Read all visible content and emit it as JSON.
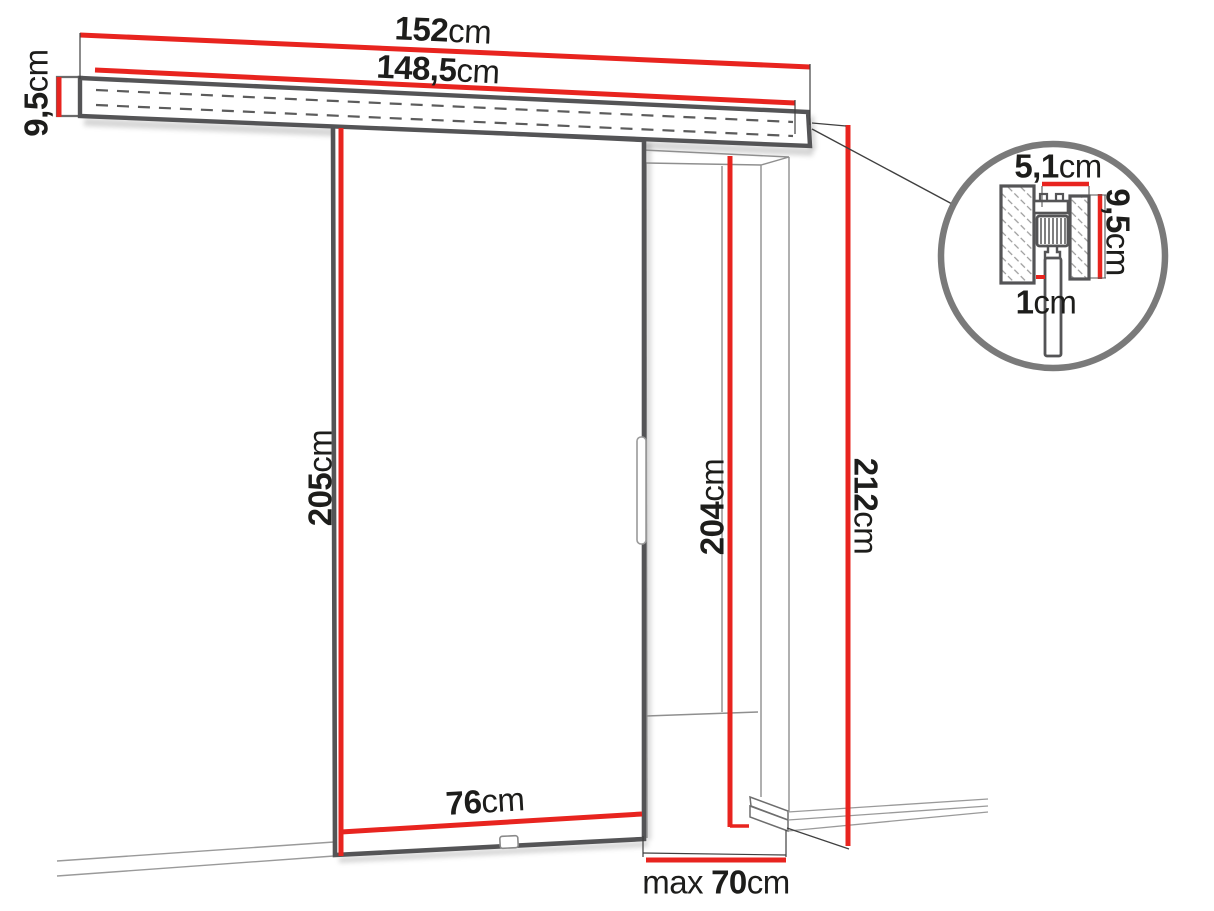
{
  "colors": {
    "dimension_red": "#e8241f",
    "structure_dark": "#545456",
    "line_light": "#8f8f8f",
    "text": "#1d1d1b"
  },
  "labels": {
    "rail_outer_width": {
      "value": "152",
      "unit": "cm"
    },
    "rail_inner_width": {
      "value": "148,5",
      "unit": "cm"
    },
    "rail_profile_height": {
      "value": "9,5",
      "unit": "cm"
    },
    "door_height": {
      "value": "205",
      "unit": "cm"
    },
    "opening_height": {
      "value": "204",
      "unit": "cm"
    },
    "overall_height": {
      "value": "212",
      "unit": "cm"
    },
    "door_width": {
      "value": "76",
      "unit": "cm"
    },
    "opening_max_width": {
      "prefix": "max",
      "value": "70",
      "unit": "cm"
    },
    "detail_track_width": {
      "value": "5,1",
      "unit": "cm"
    },
    "detail_track_height": {
      "value": "9,5",
      "unit": "cm"
    },
    "detail_gap": {
      "value": "1",
      "unit": "cm"
    }
  }
}
